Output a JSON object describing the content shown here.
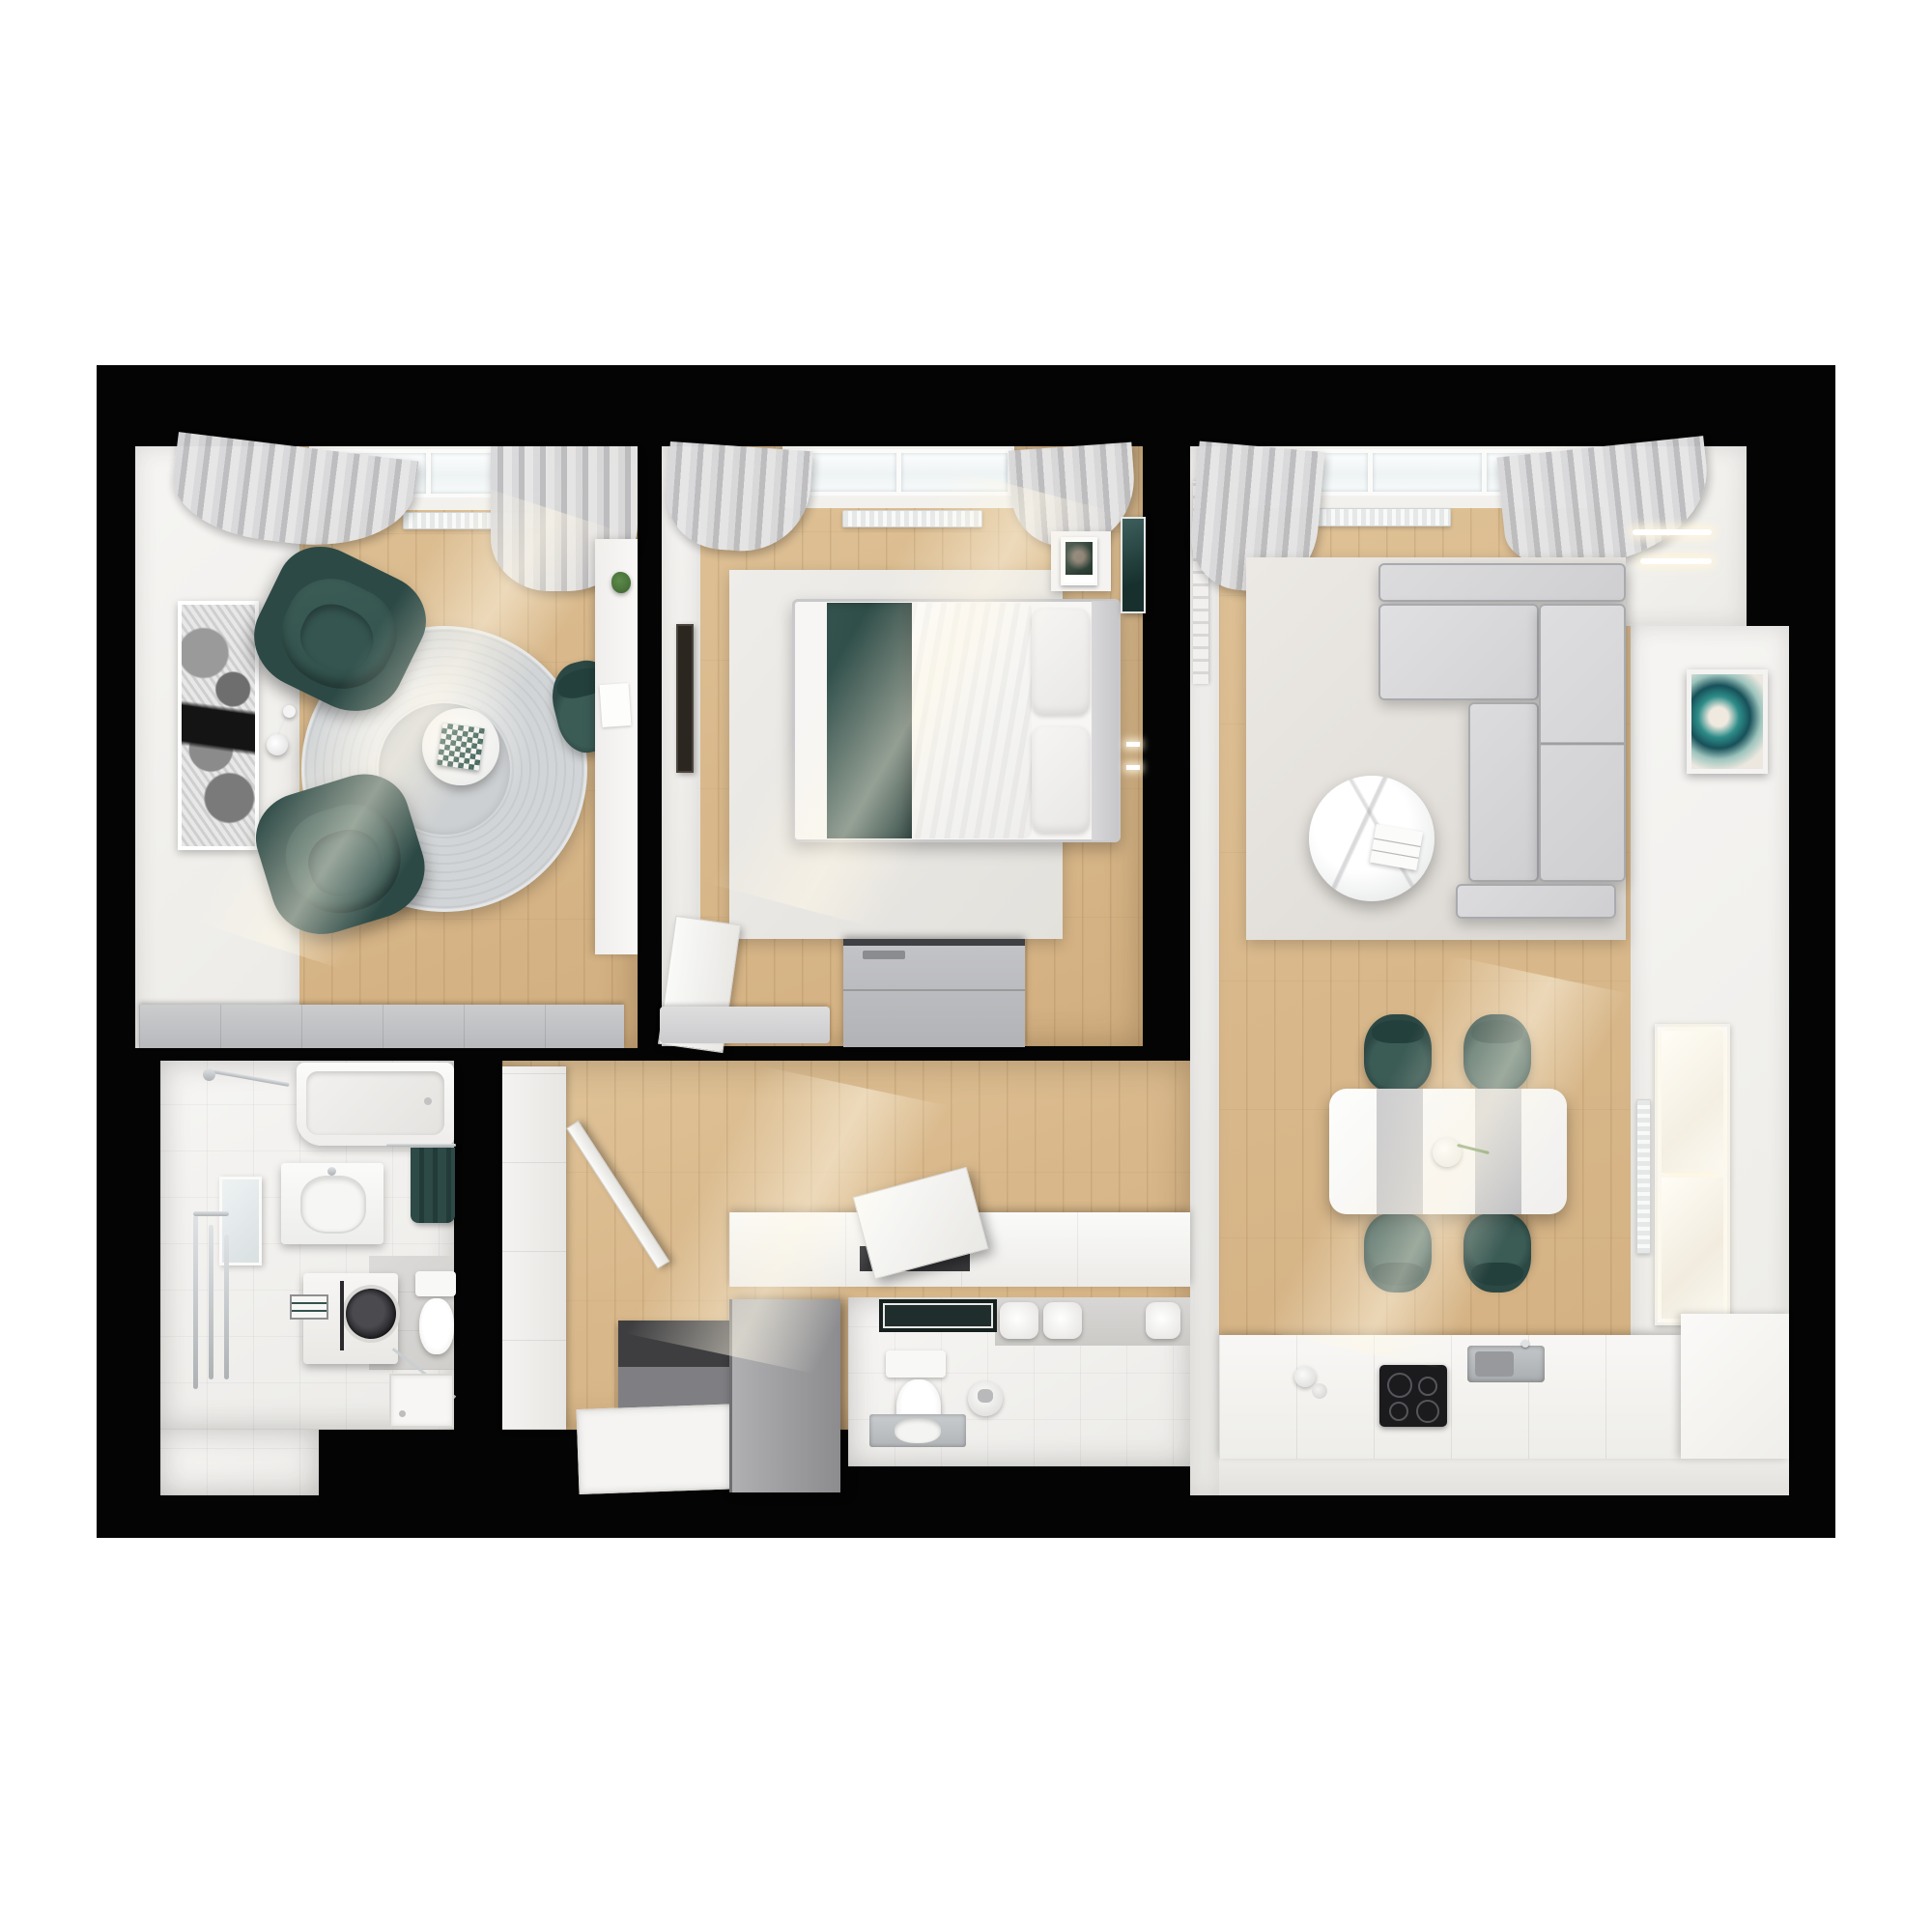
{
  "title": "3D top-down floor plan render of a one-bedroom apartment",
  "palette": {
    "page_background": "#ffffff",
    "walls": "#040404",
    "wood_floor": "#d9b98c",
    "white_surfaces": "#f6f5f3",
    "accent_teal": "#2c4945",
    "furniture_gray": "#cfcfd2",
    "rug_gray": "#d2d5d7"
  },
  "rooms": {
    "lounge": {
      "label": "Lounge study room with two teal armchairs, round gray rug, chess side table, floor lamp, wall desk, map artwork, sideboard, bay window with curtains and radiator"
    },
    "bedroom": {
      "label": "Bedroom with double bed, green throw blanket, white duvet, pillows, nightstand with photo, dresser, rug, bay window with curtains and radiator"
    },
    "living_kitchen": {
      "label": "Open living room and kitchen with corner sofa, round marble coffee table, dining table with four teal chairs, kitchen counters with cooktop and sink, windows and abstract artwork"
    },
    "bathroom": {
      "label": "Bathroom with bathtub, vanity sink, mirror, washing machine, toilet, towel radiator and shower tray"
    },
    "hallway": {
      "label": "Hallway with wardrobe, storage bench with open hatch, doormat, entry mat and open entry door"
    },
    "wc": {
      "label": "Guest WC with toilet, washbasin tray, paper rolls and dark mat"
    }
  },
  "furniture_icons": [
    "armchair-icon",
    "chess-table-icon",
    "floor-lamp-icon",
    "desk-icon",
    "bed-icon",
    "pillow-icon",
    "dresser-icon",
    "nightstand-icon",
    "sofa-icon",
    "coffee-table-icon",
    "dining-table-icon",
    "dining-chair-icon",
    "cooktop-icon",
    "sink-icon",
    "bathtub-icon",
    "washing-machine-icon",
    "toilet-icon",
    "wardrobe-icon",
    "door-icon",
    "window-icon",
    "radiator-icon",
    "curtain-icon",
    "rug-icon",
    "artwork-icon"
  ]
}
